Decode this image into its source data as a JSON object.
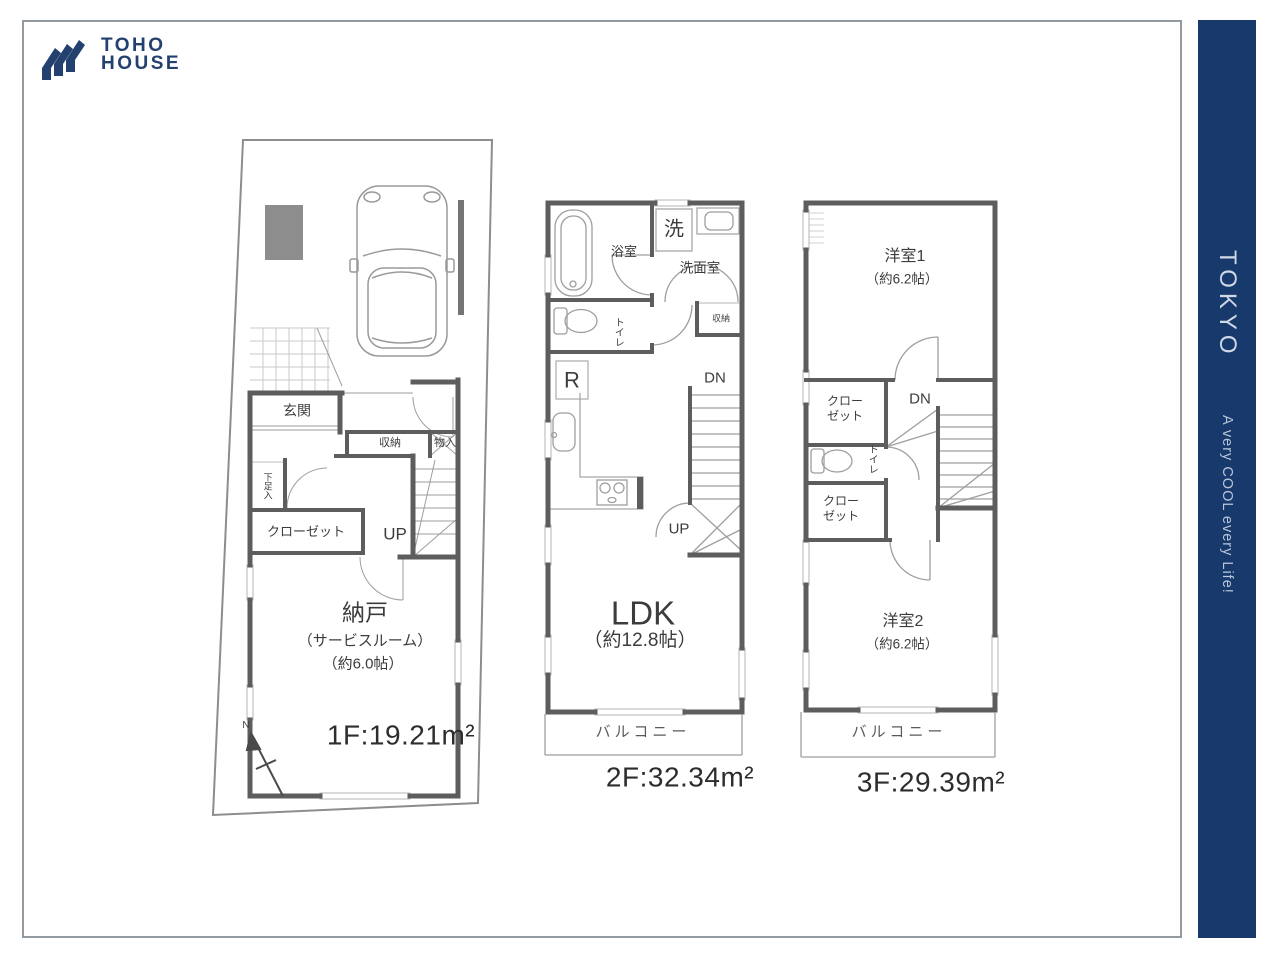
{
  "brand": {
    "line1": "TOHO",
    "line2": "HOUSE",
    "logo_color": "#24406f"
  },
  "sidebar": {
    "title": "TOKYO",
    "tagline": "A very COOL every Life!",
    "bg": "#18396b"
  },
  "colors": {
    "wall": "#5d5d5d",
    "frame": "#939aa0",
    "thin_line": "#9e9e9e"
  },
  "floor1": {
    "area_label": "1F:19.21m²",
    "labels": {
      "genkan": "玄関",
      "shuno": "収納",
      "monoire": "物入",
      "shoe": "下足入",
      "closet": "クローゼット",
      "up": "UP",
      "nando": "納戸",
      "nando_type": "（サービスルーム）",
      "nando_size": "（約6.0帖）",
      "north": "N"
    }
  },
  "floor2": {
    "area_label": "2F:32.34m²",
    "labels": {
      "bath": "浴室",
      "laundry": "洗",
      "washroom": "洗面室",
      "shuno": "収納",
      "toilet": "トイレ",
      "fridge": "R",
      "dn": "DN",
      "up": "UP",
      "ldk": "LDK",
      "ldk_size": "（約12.8帖）",
      "balcony": "バルコニー"
    }
  },
  "floor3": {
    "area_label": "3F:29.39m²",
    "labels": {
      "room1": "洋室1",
      "room1_size": "（約6.2帖）",
      "closet1": "クローゼット",
      "dn": "DN",
      "toilet": "トイレ",
      "closet2": "クローゼット",
      "room2": "洋室2",
      "room2_size": "（約6.2帖）",
      "balcony": "バルコニー"
    }
  }
}
